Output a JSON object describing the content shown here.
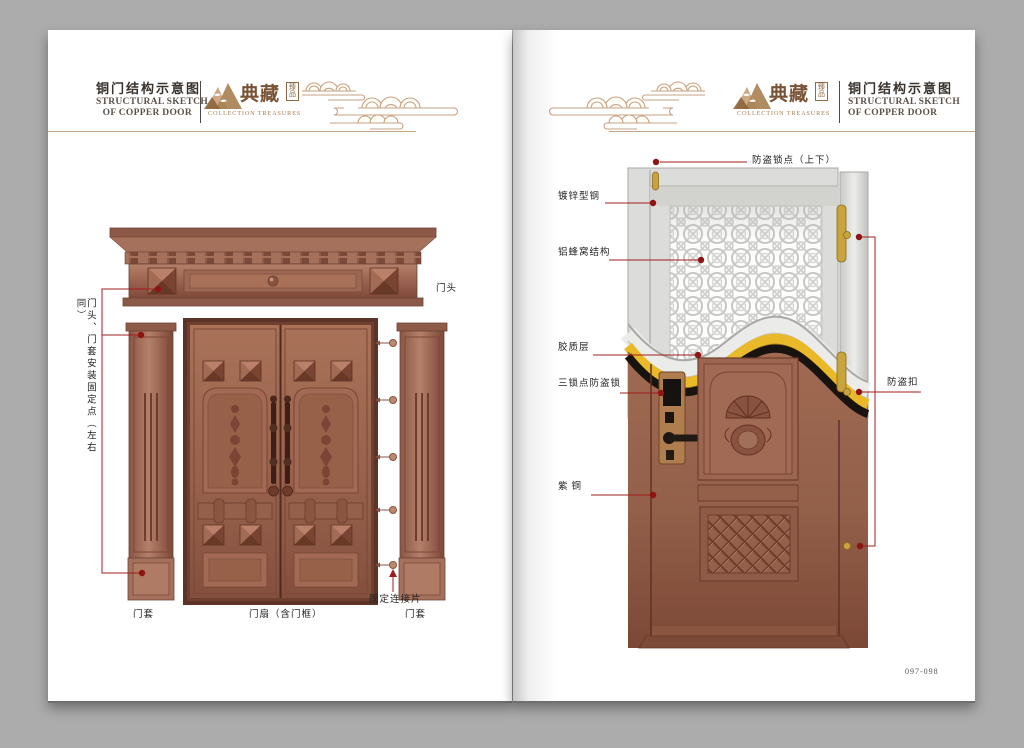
{
  "colors": {
    "accent_red": "#a01d1d",
    "copper": "#9a6450",
    "gold": "#e8b72a"
  },
  "header": {
    "title_cn": "铜门结构示意图",
    "title_en_line1": "STRUCTURAL SKETCH",
    "title_en_line2": "OF COPPER DOOR",
    "brand_cn": "典藏",
    "brand_seal_line1": "臻",
    "brand_seal_line2": "品",
    "brand_en": "COLLECTION TREASURES"
  },
  "left_page": {
    "labels": {
      "lintel": "门头",
      "install_points": "门头、门套安装固定点（左右同）",
      "connector": "固定连接片",
      "frame_left": "门套",
      "leaf": "门扇（含门框）",
      "frame_right": "门套"
    }
  },
  "right_page": {
    "labels": {
      "lock_points": "防盗锁点（上下）",
      "galvanized_steel": "镀锌型钢",
      "honeycomb": "铝蜂窝结构",
      "glue_layer": "胶质层",
      "triple_lock": "三锁点防盗锁",
      "copper": "紫铜",
      "security_buckle": "防盗扣"
    },
    "page_number": "097-098"
  }
}
